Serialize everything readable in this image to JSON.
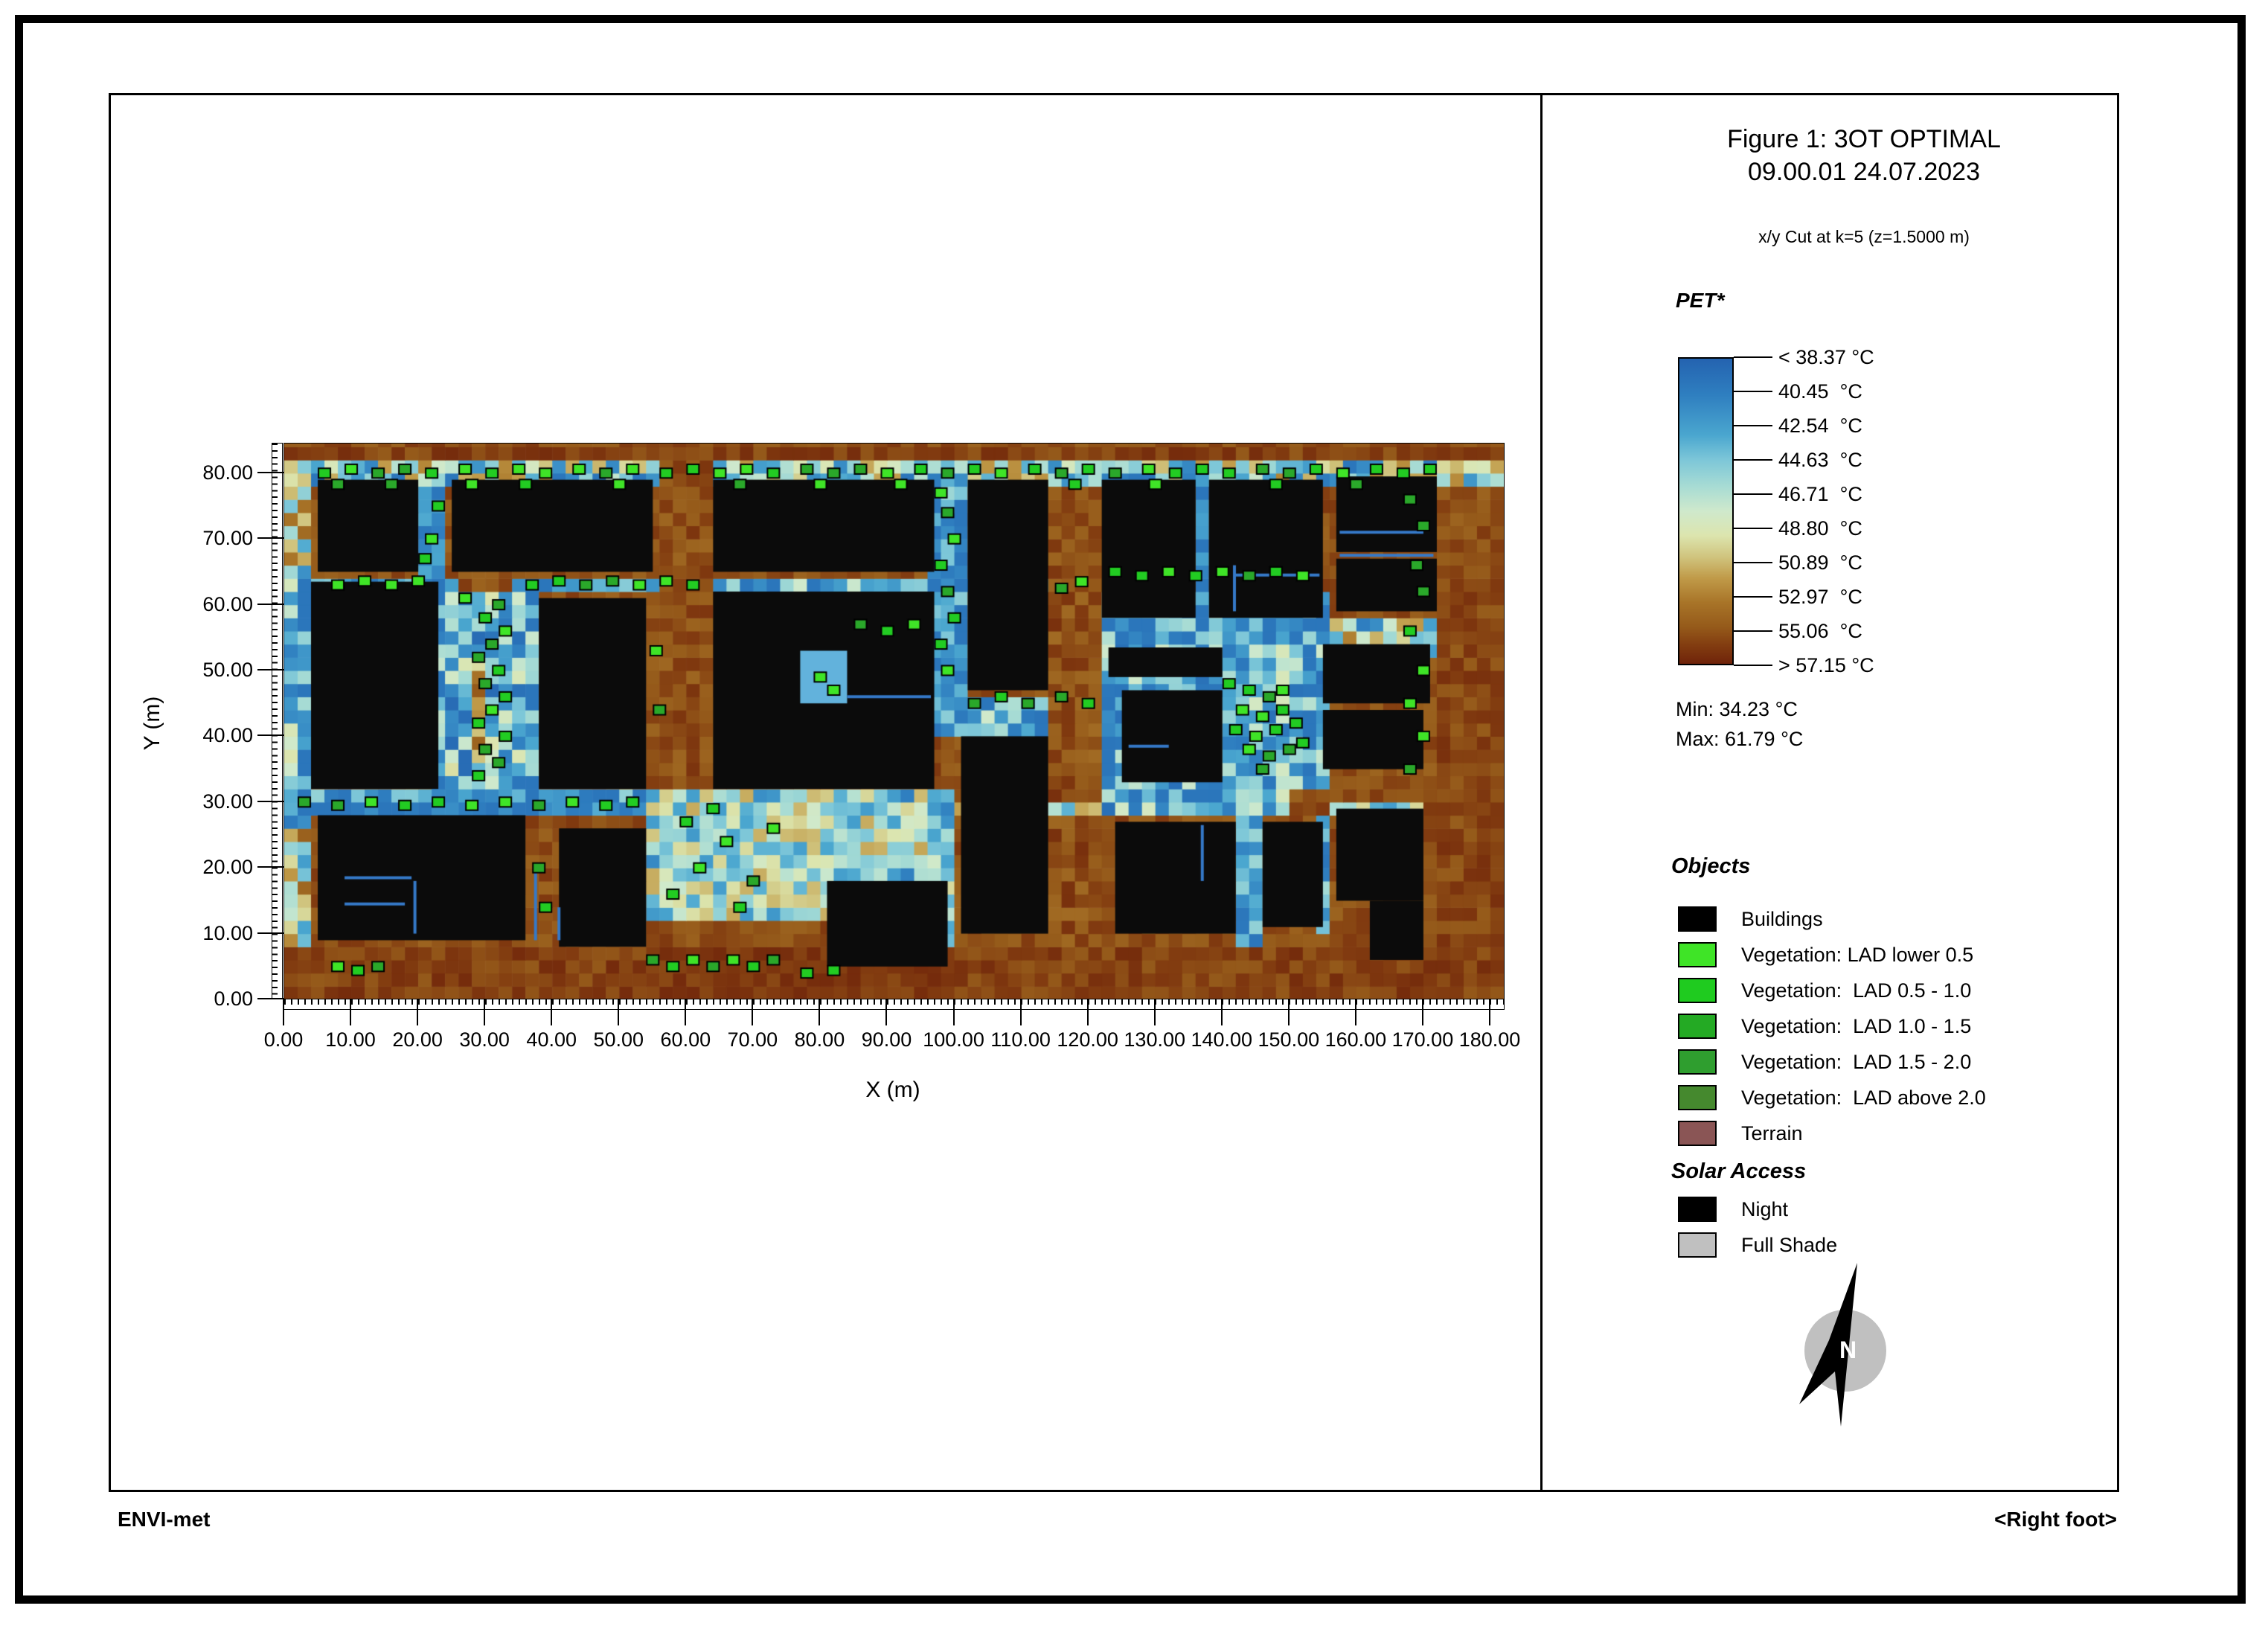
{
  "header": {
    "title": "Figure 1: 3OT OPTIMAL",
    "subtitle": "09.00.01 24.07.2023",
    "cut_info": "x/y Cut at k=5 (z=1.5000 m)"
  },
  "footer": {
    "left": "ENVI-met",
    "right": "<Right foot>"
  },
  "colorbar": {
    "label": "PET*",
    "tick_labels": [
      "< 38.37 °C",
      "40.45  °C",
      "42.54  °C",
      "44.63  °C",
      "46.71  °C",
      "48.80  °C",
      "50.89  °C",
      "52.97  °C",
      "55.06  °C",
      "> 57.15 °C"
    ],
    "min_label": "Min: 34.23 °C",
    "max_label": "Max: 61.79 °C",
    "gradient_stops": [
      [
        0,
        "#2463b0"
      ],
      [
        0.12,
        "#2f7fc0"
      ],
      [
        0.25,
        "#4aa6cf"
      ],
      [
        0.33,
        "#7cc6d8"
      ],
      [
        0.42,
        "#a8dcd4"
      ],
      [
        0.5,
        "#cfe9cc"
      ],
      [
        0.58,
        "#dce5ae"
      ],
      [
        0.65,
        "#d0c47e"
      ],
      [
        0.72,
        "#c09a48"
      ],
      [
        0.8,
        "#a87428"
      ],
      [
        0.88,
        "#955a1a"
      ],
      [
        0.94,
        "#823c10"
      ],
      [
        1,
        "#6f230a"
      ]
    ]
  },
  "objects_legend": {
    "title": "Objects",
    "items": [
      {
        "label": "Buildings",
        "color": "#000000"
      },
      {
        "label": "Vegetation: LAD lower 0.5",
        "color": "#3fe427"
      },
      {
        "label": "Vegetation:  LAD 0.5 - 1.0",
        "color": "#1fcb1f"
      },
      {
        "label": "Vegetation:  LAD 1.0 - 1.5",
        "color": "#24aa24"
      },
      {
        "label": "Vegetation:  LAD 1.5 - 2.0",
        "color": "#2f9e2f"
      },
      {
        "label": "Vegetation:  LAD above 2.0",
        "color": "#45892e"
      },
      {
        "label": "Terrain",
        "color": "#8a5555"
      }
    ]
  },
  "solar_legend": {
    "title": "Solar Access",
    "items": [
      {
        "label": "Night",
        "color": "#000000"
      },
      {
        "label": "Full Shade",
        "color": "#c0c0c0"
      }
    ]
  },
  "compass": {
    "letter": "N",
    "circle_color": "#c0c0c0",
    "needle_color": "#000000"
  },
  "axes": {
    "x_label": "X (m)",
    "y_label": "Y (m)",
    "x_tick_values": [
      0,
      10,
      20,
      30,
      40,
      50,
      60,
      70,
      80,
      90,
      100,
      110,
      120,
      130,
      140,
      150,
      160,
      170,
      180
    ],
    "x_tick_labels": [
      "0.00",
      "10.00",
      "20.00",
      "30.00",
      "40.00",
      "50.00",
      "60.00",
      "70.00",
      "80.00",
      "90.00",
      "100.00",
      "110.00",
      "120.00",
      "130.00",
      "140.00",
      "150.00",
      "160.00",
      "170.00",
      "180.00"
    ],
    "y_tick_values": [
      0,
      10,
      20,
      30,
      40,
      50,
      60,
      70,
      80
    ],
    "y_tick_labels": [
      "0.00",
      "10.00",
      "20.00",
      "30.00",
      "40.00",
      "50.00",
      "60.00",
      "70.00",
      "80.00"
    ]
  },
  "chart_data": {
    "type": "heatmap",
    "title": "Figure 1: 3OT OPTIMAL",
    "xlabel": "X (m)",
    "ylabel": "Y (m)",
    "x_range_m": [
      0,
      182
    ],
    "y_range_m": [
      0,
      84.5
    ],
    "cell_size_m": 2,
    "pet_levels_c": [
      38.37,
      40.45,
      42.54,
      44.63,
      46.71,
      48.8,
      50.89,
      52.97,
      55.06,
      57.15
    ],
    "pet_min_c": 34.23,
    "pet_max_c": 61.79,
    "base": {
      "v": 0.9,
      "n": 0.05
    },
    "zones": [
      {
        "r": [
          0,
          79,
          182,
          81.8
        ],
        "v": 0.45,
        "n": 0.32
      },
      {
        "r": [
          0,
          81.8,
          182,
          84.5
        ],
        "v": 0.93,
        "n": 0.05
      },
      {
        "r": [
          0,
          26,
          5,
          66
        ],
        "v": 0.32,
        "n": 0.26
      },
      {
        "r": [
          0,
          66,
          5,
          79
        ],
        "v": 0.55,
        "n": 0.3
      },
      {
        "r": [
          0,
          8,
          5,
          26
        ],
        "v": 0.6,
        "n": 0.3
      },
      {
        "r": [
          5,
          61.5,
          38,
          65
        ],
        "v": 0.22,
        "n": 0.14
      },
      {
        "r": [
          25.5,
          60,
          35,
          65
        ],
        "v": 0.9,
        "n": 0.05
      },
      {
        "r": [
          38,
          61.5,
          64,
          65
        ],
        "v": 0.3,
        "n": 0.2
      },
      {
        "r": [
          64,
          61.5,
          97,
          65
        ],
        "v": 0.45,
        "n": 0.3
      },
      {
        "r": [
          97,
          61.5,
          122,
          65
        ],
        "v": 0.38,
        "n": 0.3
      },
      {
        "r": [
          20,
          65,
          25,
          79
        ],
        "v": 0.25,
        "n": 0.15
      },
      {
        "r": [
          23,
          30,
          38,
          62
        ],
        "v": 0.3,
        "n": 0.3
      },
      {
        "r": [
          28.5,
          36,
          31,
          50
        ],
        "v": 0.75,
        "n": 0.15
      },
      {
        "r": [
          0,
          28,
          55,
          32
        ],
        "v": 0.28,
        "n": 0.2
      },
      {
        "r": [
          5,
          28.5,
          54,
          30.5
        ],
        "v": 0.18,
        "n": 0.1
      },
      {
        "r": [
          54,
          13,
          101,
          32
        ],
        "v": 0.45,
        "n": 0.25
      },
      {
        "r": [
          55.5,
          32,
          64,
          81.8
        ],
        "v": 0.9,
        "n": 0.06
      },
      {
        "r": [
          97,
          44,
          102,
          81.8
        ],
        "v": 0.26,
        "n": 0.2
      },
      {
        "r": [
          97,
          40,
          122,
          47
        ],
        "v": 0.3,
        "n": 0.25
      },
      {
        "r": [
          114,
          8,
          122,
          66
        ],
        "v": 0.9,
        "n": 0.07
      },
      {
        "r": [
          122,
          27.5,
          157,
          62
        ],
        "v": 0.3,
        "n": 0.25
      },
      {
        "r": [
          150,
          25,
          157,
          32
        ],
        "v": 0.88,
        "n": 0.08
      },
      {
        "r": [
          101,
          27.5,
          122,
          31
        ],
        "v": 0.5,
        "n": 0.3
      },
      {
        "r": [
          157,
          27.5,
          170,
          31
        ],
        "v": 0.45,
        "n": 0.3
      },
      {
        "r": [
          142,
          8,
          146,
          27.5
        ],
        "v": 0.35,
        "n": 0.2
      },
      {
        "r": [
          155,
          11,
          157,
          29
        ],
        "v": 0.35,
        "n": 0.2
      },
      {
        "r": [
          157,
          53,
          172,
          58
        ],
        "v": 0.5,
        "n": 0.3
      },
      {
        "r": [
          136,
          58,
          138,
          81
        ],
        "v": 0.25,
        "n": 0.15
      },
      {
        "r": [
          155.5,
          58,
          157,
          81
        ],
        "v": 0.25,
        "n": 0.15
      },
      {
        "r": [
          99,
          5,
          101,
          20
        ],
        "v": 0.4,
        "n": 0.25
      },
      {
        "r": [
          172,
          8,
          182,
          66
        ],
        "v": 0.92,
        "n": 0.05
      },
      {
        "r": [
          0,
          0,
          182,
          8
        ],
        "v": 0.93,
        "n": 0.05
      },
      {
        "r": [
          55,
          0,
          101,
          8
        ],
        "v": 0.95,
        "n": 0.04
      }
    ],
    "buildings_m": [
      [
        5,
        65,
        20,
        79
      ],
      [
        4,
        32,
        23,
        63.5
      ],
      [
        25,
        65,
        55,
        79
      ],
      [
        38,
        32,
        54,
        61
      ],
      [
        5,
        9,
        36,
        28
      ],
      [
        41,
        8,
        54,
        26
      ],
      [
        64,
        65,
        97,
        79
      ],
      [
        64,
        32,
        97,
        62
      ],
      [
        102,
        47,
        114,
        79
      ],
      [
        101,
        10,
        114,
        40
      ],
      [
        122,
        58,
        136,
        79
      ],
      [
        138,
        58,
        155,
        79
      ],
      [
        157,
        68,
        172,
        79.5
      ],
      [
        157,
        59,
        172,
        67
      ],
      [
        123,
        49,
        140,
        53.5
      ],
      [
        125,
        33,
        140,
        47
      ],
      [
        155,
        45,
        171,
        54
      ],
      [
        155,
        35,
        170,
        44
      ],
      [
        124,
        10,
        142,
        27
      ],
      [
        146,
        11,
        155,
        27
      ],
      [
        157,
        15,
        170,
        29
      ],
      [
        162,
        6,
        170,
        15
      ],
      [
        81,
        5,
        99,
        18
      ]
    ],
    "courtyards_m": [
      [
        77,
        45,
        84,
        53
      ]
    ],
    "slits_m": [
      [
        9,
        18.5,
        19,
        18.5
      ],
      [
        9,
        14.5,
        18,
        14.5
      ],
      [
        19.5,
        10,
        19.5,
        18
      ],
      [
        37.5,
        9,
        37.5,
        20
      ],
      [
        41,
        9,
        41,
        14
      ],
      [
        84,
        46,
        96.5,
        46
      ],
      [
        157.5,
        67.5,
        171.5,
        67.5
      ],
      [
        157.5,
        71,
        170,
        71
      ],
      [
        141.8,
        59,
        141.8,
        66
      ],
      [
        142,
        64.5,
        154.5,
        64.5
      ],
      [
        126,
        38.5,
        132,
        38.5
      ],
      [
        137,
        18,
        137,
        26.5
      ]
    ],
    "slit_color": "#3579c8",
    "courtyard_color": "#62b2dc",
    "building_color": "#0b0b0b",
    "vegetation": {
      "colors": [
        "#3fe427",
        "#22cc22",
        "#2aa82a"
      ],
      "cells_m": [
        [
          6,
          80
        ],
        [
          10,
          80.6
        ],
        [
          14,
          80
        ],
        [
          18,
          80.6
        ],
        [
          22,
          80
        ],
        [
          27,
          80.6
        ],
        [
          31,
          80
        ],
        [
          35,
          80.6
        ],
        [
          39,
          80
        ],
        [
          44,
          80.6
        ],
        [
          48,
          80
        ],
        [
          52,
          80.6
        ],
        [
          57,
          80
        ],
        [
          61,
          80.6
        ],
        [
          65,
          80
        ],
        [
          69,
          80.6
        ],
        [
          73,
          80
        ],
        [
          78,
          80.6
        ],
        [
          82,
          80
        ],
        [
          86,
          80.6
        ],
        [
          90,
          80
        ],
        [
          95,
          80.6
        ],
        [
          99,
          80
        ],
        [
          103,
          80.6
        ],
        [
          107,
          80
        ],
        [
          112,
          80.6
        ],
        [
          116,
          80
        ],
        [
          120,
          80.6
        ],
        [
          124,
          80
        ],
        [
          129,
          80.6
        ],
        [
          133,
          80
        ],
        [
          137,
          80.6
        ],
        [
          141,
          80
        ],
        [
          146,
          80.6
        ],
        [
          150,
          80
        ],
        [
          154,
          80.6
        ],
        [
          158,
          80
        ],
        [
          163,
          80.6
        ],
        [
          167,
          80
        ],
        [
          171,
          80.6
        ],
        [
          8,
          78.3
        ],
        [
          16,
          78.3
        ],
        [
          28,
          78.3
        ],
        [
          36,
          78.3
        ],
        [
          50,
          78.3
        ],
        [
          68,
          78.3
        ],
        [
          80,
          78.3
        ],
        [
          92,
          78.3
        ],
        [
          118,
          78.3
        ],
        [
          130,
          78.3
        ],
        [
          148,
          78.3
        ],
        [
          160,
          78.3
        ],
        [
          29,
          34
        ],
        [
          32,
          36
        ],
        [
          30,
          38
        ],
        [
          33,
          40
        ],
        [
          29,
          42
        ],
        [
          31,
          44
        ],
        [
          33,
          46
        ],
        [
          30,
          48
        ],
        [
          32,
          50
        ],
        [
          29,
          52
        ],
        [
          31,
          54
        ],
        [
          33,
          56
        ],
        [
          30,
          58
        ],
        [
          32,
          60
        ],
        [
          27,
          61
        ],
        [
          8,
          63
        ],
        [
          12,
          63.6
        ],
        [
          16,
          63
        ],
        [
          20,
          63.6
        ],
        [
          37,
          63
        ],
        [
          41,
          63.6
        ],
        [
          45,
          63
        ],
        [
          49,
          63.6
        ],
        [
          53,
          63
        ],
        [
          57,
          63.6
        ],
        [
          61,
          63
        ],
        [
          3,
          30
        ],
        [
          8,
          29.5
        ],
        [
          13,
          30
        ],
        [
          18,
          29.5
        ],
        [
          23,
          30
        ],
        [
          28,
          29.5
        ],
        [
          33,
          30
        ],
        [
          38,
          29.5
        ],
        [
          43,
          30
        ],
        [
          48,
          29.5
        ],
        [
          52,
          30
        ],
        [
          8,
          5
        ],
        [
          11,
          4.4
        ],
        [
          14,
          5
        ],
        [
          55,
          6
        ],
        [
          58,
          5
        ],
        [
          61,
          6
        ],
        [
          64,
          5
        ],
        [
          67,
          6
        ],
        [
          70,
          5
        ],
        [
          73,
          6
        ],
        [
          78,
          4
        ],
        [
          82,
          4.4
        ],
        [
          58,
          16
        ],
        [
          62,
          20
        ],
        [
          66,
          24
        ],
        [
          70,
          18
        ],
        [
          73,
          26
        ],
        [
          60,
          27
        ],
        [
          68,
          14
        ],
        [
          64,
          29
        ],
        [
          99,
          50
        ],
        [
          98,
          54
        ],
        [
          100,
          58
        ],
        [
          99,
          62
        ],
        [
          98,
          66
        ],
        [
          100,
          70
        ],
        [
          99,
          74
        ],
        [
          98,
          77
        ],
        [
          103,
          45
        ],
        [
          107,
          46
        ],
        [
          111,
          45
        ],
        [
          116,
          46
        ],
        [
          120,
          45
        ],
        [
          141,
          48
        ],
        [
          144,
          47
        ],
        [
          147,
          46
        ],
        [
          143,
          44
        ],
        [
          146,
          43
        ],
        [
          149,
          44
        ],
        [
          142,
          41
        ],
        [
          145,
          40
        ],
        [
          148,
          41
        ],
        [
          151,
          42
        ],
        [
          144,
          38
        ],
        [
          147,
          37
        ],
        [
          150,
          38
        ],
        [
          146,
          35
        ],
        [
          149,
          47
        ],
        [
          152,
          39
        ],
        [
          168,
          35
        ],
        [
          170,
          40
        ],
        [
          168,
          45
        ],
        [
          170,
          50
        ],
        [
          168,
          56
        ],
        [
          170,
          62
        ],
        [
          169,
          66
        ],
        [
          170,
          72
        ],
        [
          168,
          76
        ],
        [
          124,
          65
        ],
        [
          128,
          64.4
        ],
        [
          132,
          65
        ],
        [
          136,
          64.4
        ],
        [
          140,
          65
        ],
        [
          144,
          64.4
        ],
        [
          148,
          65
        ],
        [
          152,
          64.4
        ],
        [
          86,
          57
        ],
        [
          90,
          56
        ],
        [
          94,
          57
        ],
        [
          80,
          49
        ],
        [
          82,
          47
        ],
        [
          116,
          62.5
        ],
        [
          119,
          63.5
        ],
        [
          22,
          70
        ],
        [
          23,
          75
        ],
        [
          21,
          67
        ],
        [
          38,
          20
        ],
        [
          39,
          14
        ],
        [
          56,
          44
        ],
        [
          55.5,
          53
        ]
      ]
    }
  }
}
